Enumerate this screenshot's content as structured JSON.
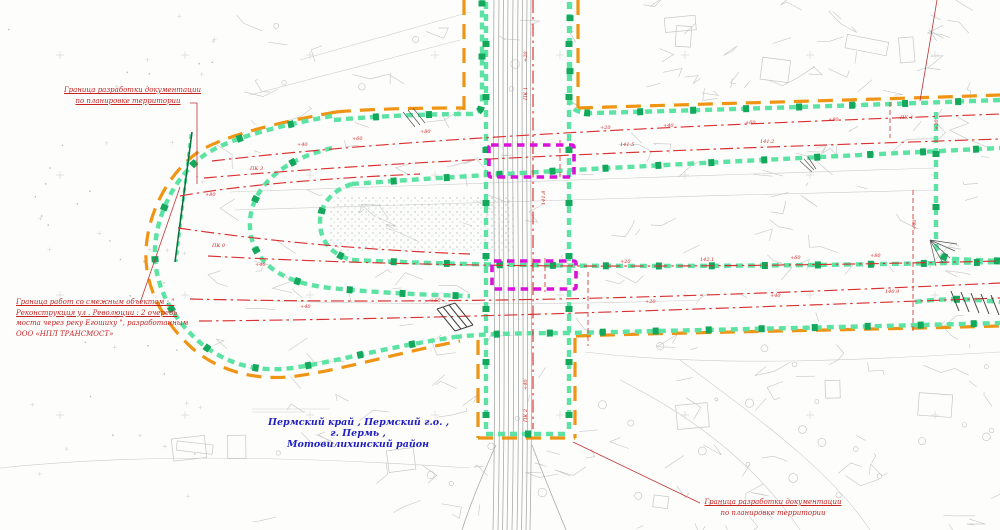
{
  "title": "План границ разработки документации по планировке территории",
  "annotations": {
    "top_left": {
      "line1": "Граница разработки документации",
      "line2": "по планировке территории"
    },
    "adjacent_work": {
      "line1": "Граница работ со смежным объектом : \"",
      "line2": "Реконструкция ул . Революции : 2 очередь",
      "line3": "моста через реку Егошиху \", разработанным",
      "line4": "ООО «НПЛ ТРАНСМОСТ»"
    },
    "bottom_right": {
      "line1": "Граница разработки документации",
      "line2": "по планировке территории"
    }
  },
  "location": {
    "line1": "Пермский край , Пермский г.о. ,",
    "line2": "г. Пермь ,",
    "line3": "Мотовилихинский район"
  },
  "colors": {
    "planning_boundary_orange": "#ef9413",
    "work_boundary_green": "#5ce3a3",
    "work_boundary_green_dark": "#14a85d",
    "road_axis_red": "#d93030",
    "bridge_zone_magenta": "#d812d8",
    "annotation_red": "#c52222",
    "location_blue": "#2020bf",
    "topo_gray": "#c9c9c9"
  },
  "station_labels": [
    {
      "x": 297,
      "y": 146,
      "t": "+40"
    },
    {
      "x": 352,
      "y": 140,
      "t": "+60"
    },
    {
      "x": 420,
      "y": 133,
      "t": "+80"
    },
    {
      "x": 600,
      "y": 129,
      "t": "+20"
    },
    {
      "x": 663,
      "y": 127,
      "t": "+40"
    },
    {
      "x": 745,
      "y": 124,
      "t": "+60"
    },
    {
      "x": 828,
      "y": 121,
      "t": "+80"
    },
    {
      "x": 900,
      "y": 119,
      "t": "ПК 4"
    },
    {
      "x": 250,
      "y": 170,
      "t": "ПК 3"
    },
    {
      "x": 620,
      "y": 146,
      "t": "141.5"
    },
    {
      "x": 760,
      "y": 143,
      "t": "141.2"
    },
    {
      "x": 255,
      "y": 266,
      "t": "+40"
    },
    {
      "x": 620,
      "y": 263,
      "t": "+20"
    },
    {
      "x": 700,
      "y": 261,
      "t": "142.1"
    },
    {
      "x": 790,
      "y": 259,
      "t": "+60"
    },
    {
      "x": 870,
      "y": 257,
      "t": "+80"
    },
    {
      "x": 300,
      "y": 308,
      "t": "+40"
    },
    {
      "x": 430,
      "y": 302,
      "t": "+60"
    },
    {
      "x": 645,
      "y": 303,
      "t": "+20"
    },
    {
      "x": 770,
      "y": 297,
      "t": "+40"
    },
    {
      "x": 885,
      "y": 293,
      "t": "140.9"
    },
    {
      "x": 205,
      "y": 196,
      "t": "+80"
    },
    {
      "x": 212,
      "y": 247,
      "t": "ПК 0"
    },
    {
      "x": 527,
      "y": 62,
      "t": "+20",
      "rot": -90
    },
    {
      "x": 527,
      "y": 100,
      "t": "ПК 1",
      "rot": -90
    },
    {
      "x": 545,
      "y": 205,
      "t": "141.8",
      "rot": -90
    },
    {
      "x": 527,
      "y": 390,
      "t": "+40",
      "rot": -90
    },
    {
      "x": 527,
      "y": 422,
      "t": "ПК 2",
      "rot": -90
    },
    {
      "x": 938,
      "y": 130,
      "t": "+20",
      "rot": -90
    },
    {
      "x": 916,
      "y": 230,
      "t": "+40",
      "rot": -90
    }
  ]
}
